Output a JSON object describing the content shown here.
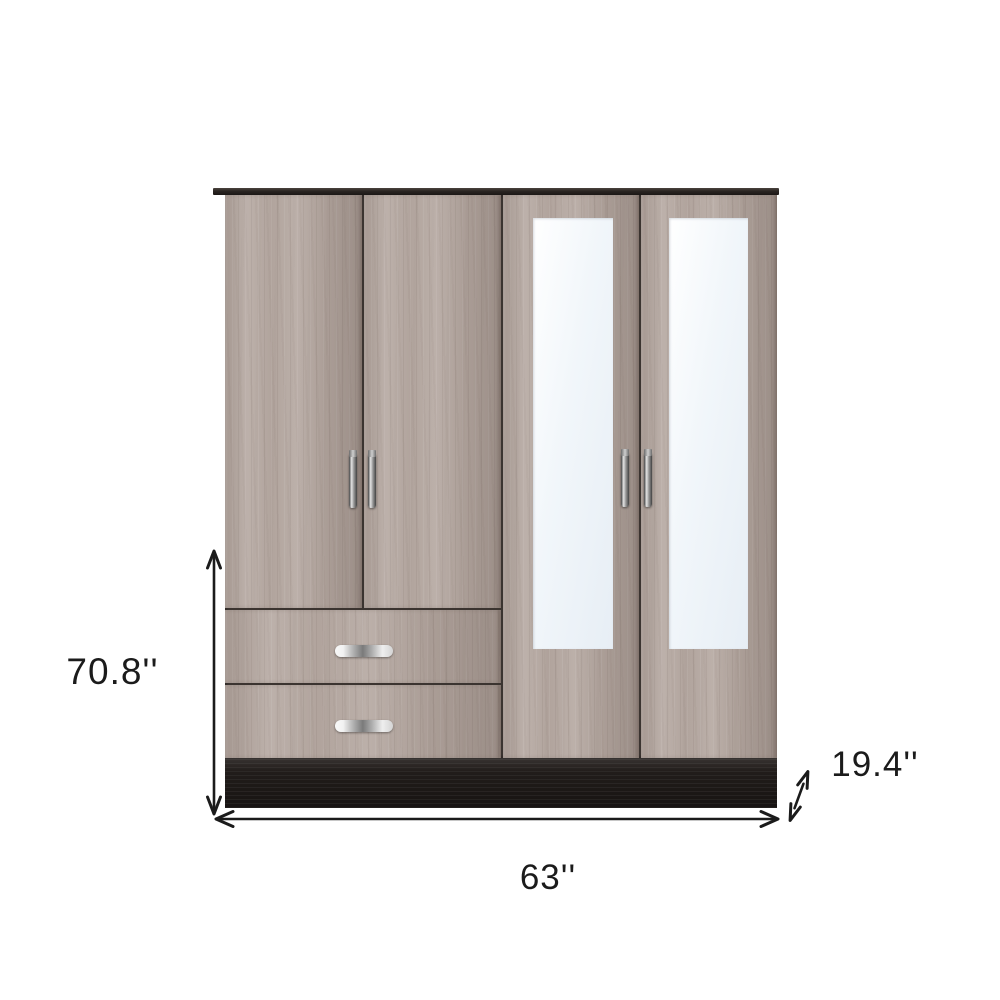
{
  "scene": {
    "type": "product-dimension-image",
    "description": "Four-door wardrobe armoire with two mirrored doors, two drawers, chrome handles, black top trim and black base plinth, annotated with overall dimensions on a white background"
  },
  "dimensions": {
    "height_label": "70.8''",
    "width_label": "63''",
    "depth_label": "19.4''"
  },
  "colors": {
    "wood": "#b5a8a1",
    "wood_dark": "#9c8f88",
    "seam": "#3b3430",
    "top_trim": "#24201d",
    "base": "#211c1a",
    "mirror": "#f1f6fa",
    "handle_chrome": "#c9c9c9",
    "annotation": "#1b1b1b",
    "background": "#ffffff"
  }
}
